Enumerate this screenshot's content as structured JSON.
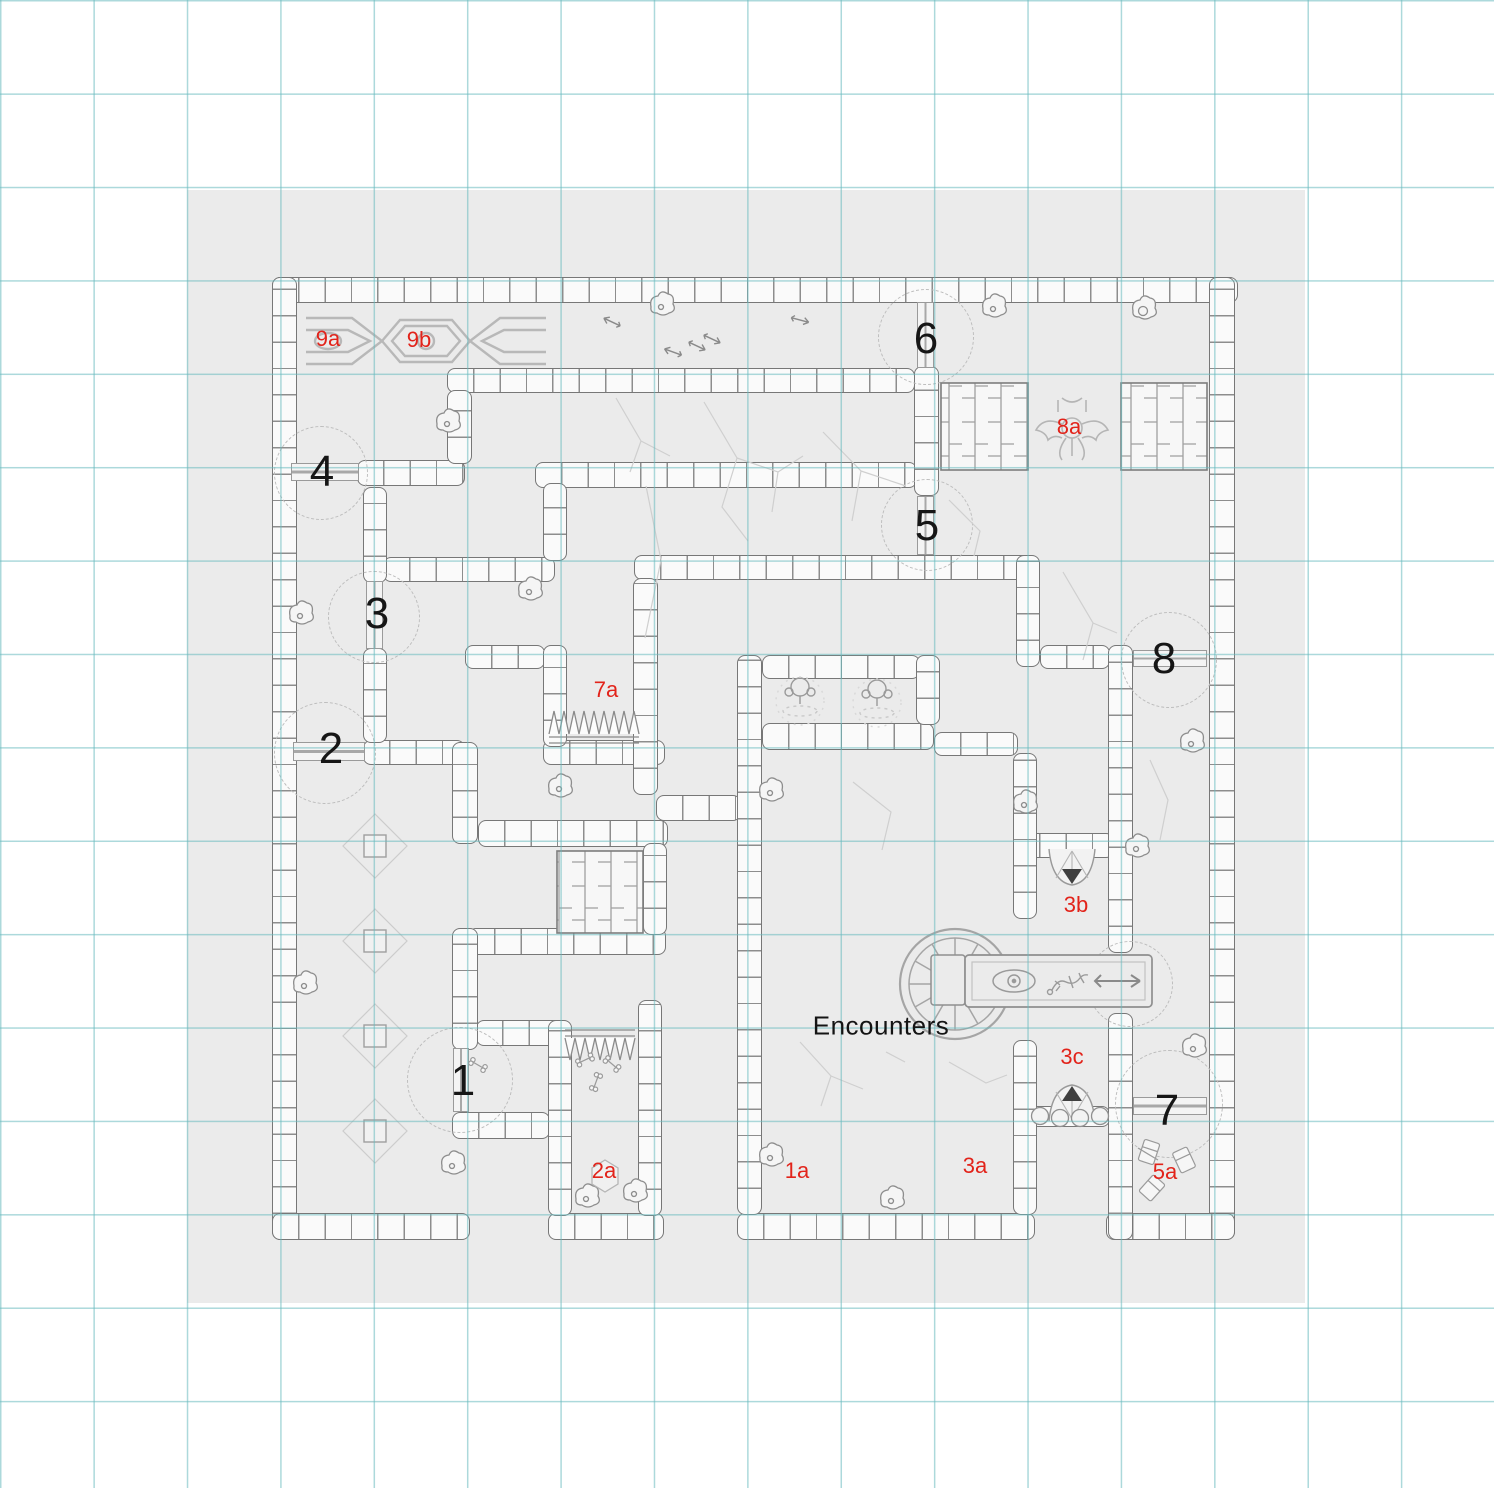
{
  "canvas": {
    "background": "#ffffff"
  },
  "grid": {
    "color": "#a9d6d8",
    "cell_px": 93
  },
  "map_sheet": {
    "background": "#ebebeb"
  },
  "palette": {
    "label_red": "#e2231a",
    "label_black": "#161616",
    "wall_line": "#8a8a8a",
    "crack": "#cfcfcf"
  },
  "text": {
    "encounters": "Encounters"
  },
  "door_numbers": [
    {
      "text": "1"
    },
    {
      "text": "2"
    },
    {
      "text": "3"
    },
    {
      "text": "4"
    },
    {
      "text": "5"
    },
    {
      "text": "6"
    },
    {
      "text": "7"
    },
    {
      "text": "8"
    }
  ],
  "area_labels": [
    {
      "text": "9a"
    },
    {
      "text": "9b"
    },
    {
      "text": "8a"
    },
    {
      "text": "7a"
    },
    {
      "text": "3b"
    },
    {
      "text": "3c"
    },
    {
      "text": "2a"
    },
    {
      "text": "1a"
    },
    {
      "text": "3a"
    },
    {
      "text": "5a"
    }
  ],
  "icons": [
    "staircase-icon",
    "spike-trap-icon",
    "sarcophagus-icon",
    "wheel-icon",
    "fountain-icon",
    "altar-icon",
    "gargoyle-icon",
    "emblem-icon",
    "sigil-icon",
    "diamond-tile-icon",
    "bone-icon",
    "book-icon",
    "arrow-icon",
    "door-icon",
    "door-swing-arc"
  ]
}
